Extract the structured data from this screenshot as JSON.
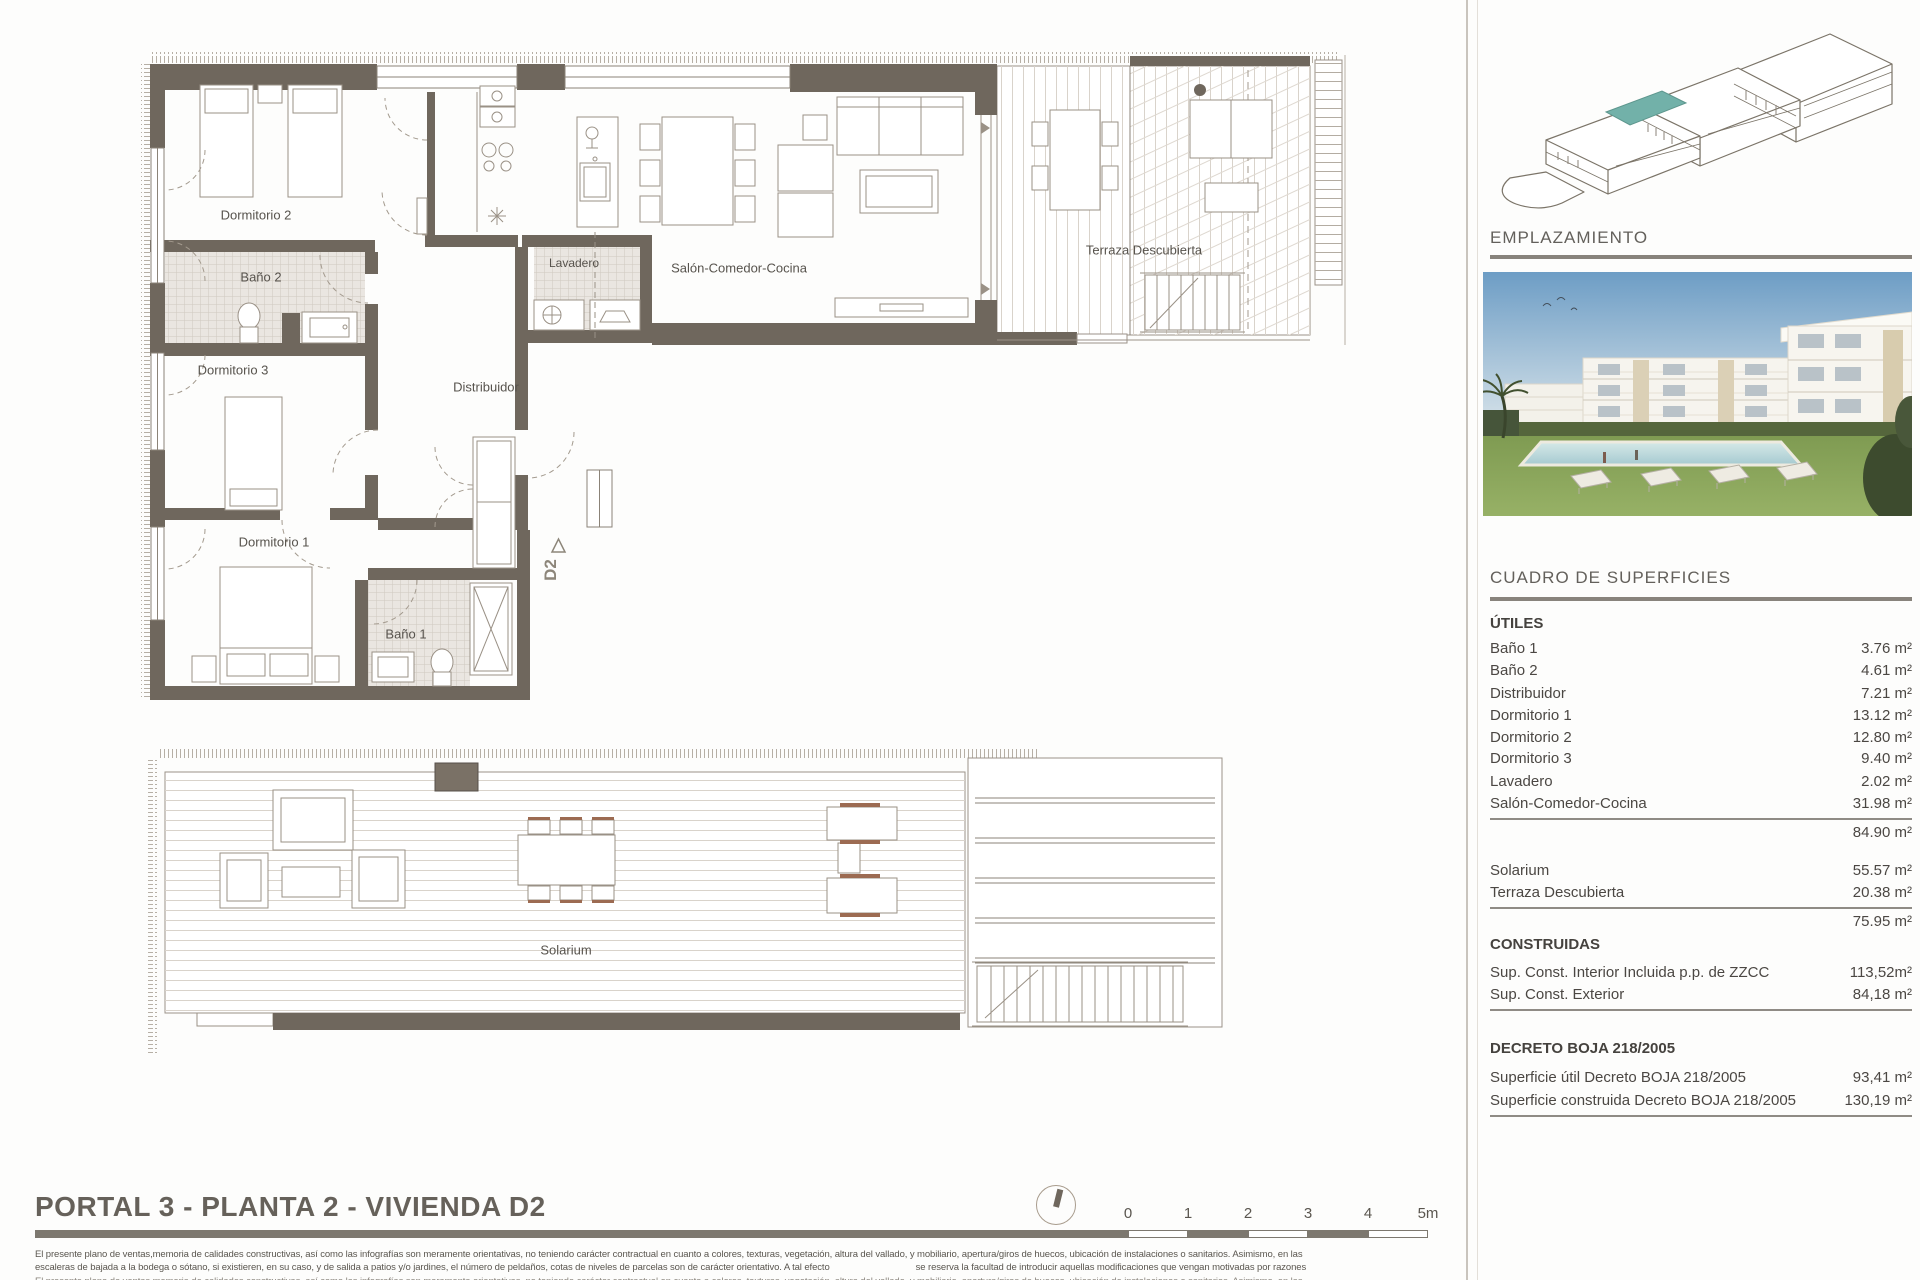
{
  "title": "PORTAL 3 - PLANTA 2 - VIVIENDA D2",
  "plan": {
    "rooms": {
      "dormitorio2": "Dormitorio 2",
      "bano2": "Baño 2",
      "dormitorio3": "Dormitorio 3",
      "dormitorio1": "Dormitorio 1",
      "bano1": "Baño 1",
      "lavadero": "Lavadero",
      "distribuidor": "Distribuidor",
      "salon": "Salón-Comedor-Cocina",
      "terraza": "Terraza Descubierta",
      "solarium": "Solarium"
    },
    "unit_marker": "D2"
  },
  "scale_bar": {
    "labels": [
      "0",
      "1",
      "2",
      "3",
      "4",
      "5m"
    ]
  },
  "panel": {
    "emplazamiento_heading": "EMPLAZAMIENTO",
    "cuadro_heading": "CUADRO DE SUPERFICIES",
    "utiles_heading": "ÚTILES",
    "utiles_rows": [
      {
        "label": "Baño 1",
        "value": "3.76 m²"
      },
      {
        "label": "Baño 2",
        "value": "4.61 m²"
      },
      {
        "label": "Distribuidor",
        "value": "7.21 m²"
      },
      {
        "label": "Dormitorio 1",
        "value": "13.12 m²"
      },
      {
        "label": "Dormitorio 2",
        "value": "12.80 m²"
      },
      {
        "label": "Dormitorio 3",
        "value": "9.40 m²"
      },
      {
        "label": "Lavadero",
        "value": "2.02 m²"
      },
      {
        "label": "Salón-Comedor-Cocina",
        "value": "31.98 m²"
      }
    ],
    "utiles_total": "84.90 m²",
    "exterior_rows": [
      {
        "label": "Solarium",
        "value": "55.57 m²"
      },
      {
        "label": "Terraza Descubierta",
        "value": "20.38 m²"
      }
    ],
    "exterior_total": "75.95 m²",
    "construidas_heading": "CONSTRUIDAS",
    "construidas_rows": [
      {
        "label": "Sup. Const. Interior Incluida p.p. de ZZCC",
        "value": "113,52m²"
      },
      {
        "label": "Sup. Const. Exterior",
        "value": "84,18 m²"
      }
    ],
    "decreto_heading": "DECRETO BOJA 218/2005",
    "decreto_rows": [
      {
        "label": "Superficie útil Decreto BOJA 218/2005",
        "value": "93,41 m²"
      },
      {
        "label": "Superficie construida Decreto BOJA 218/2005",
        "value": "130,19 m²"
      }
    ]
  },
  "disclaimer": {
    "line1": "El presente plano de ventas,memoria de calidades constructivas, así como las infografías son meramente orientativas, no teniendo carácter contractual en cuanto a colores, texturas, vegetación, altura del vallado, y mobiliario, apertura/giros de huecos, ubicación de instalaciones o sanitarios. Asimismo, en las",
    "line2_before_gap": "escaleras de bajada a la bodega o sótano, si existieren, en su caso, y de salida a patios y/o jardines, el número de peldaños, cotas de niveles de parcelas son de carácter orientativo. A tal efecto",
    "line2_after_gap": "se reserva la facultad de introducir aquellas modificaciones que vengan motivadas por razones"
  },
  "colors": {
    "wall": "#6f675d",
    "highlight_teal": "#72b1a9"
  }
}
